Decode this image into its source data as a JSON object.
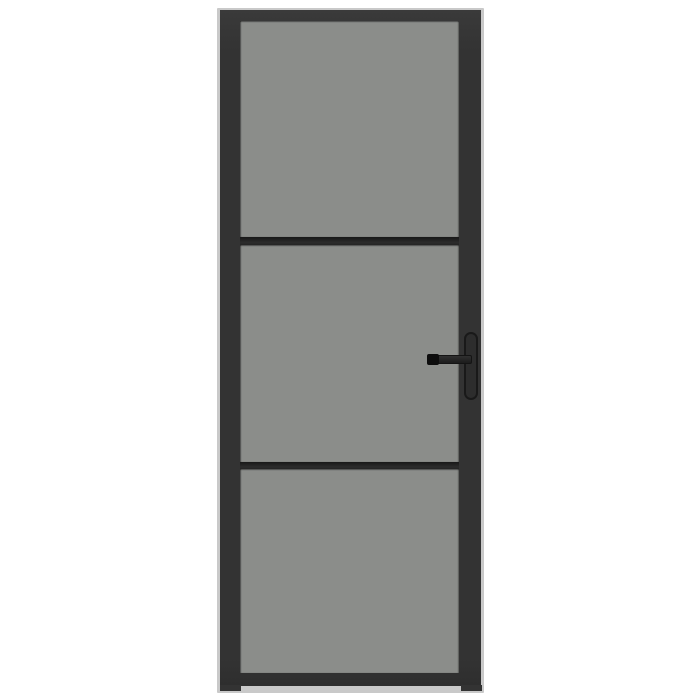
{
  "image": {
    "type": "product-photo",
    "subject": "interior door with black metal frame, three smoked-glass panels and a black lever handle on the right",
    "panel_count": 3,
    "handle_side": "right"
  },
  "colors": {
    "background": "#ffffff",
    "frame": "#333333",
    "frame-top": "#3a3a3a",
    "frame-edge": "#c9c9c9",
    "muntin": "#2c2c2c",
    "muntin-dark": "#181818",
    "glass": "#8b8d8a",
    "handle": "#1c1c1c",
    "handle-tip": "#0d0d0d",
    "handle-plate": "#2d2d2d",
    "handle-plate-border": "#191919"
  }
}
